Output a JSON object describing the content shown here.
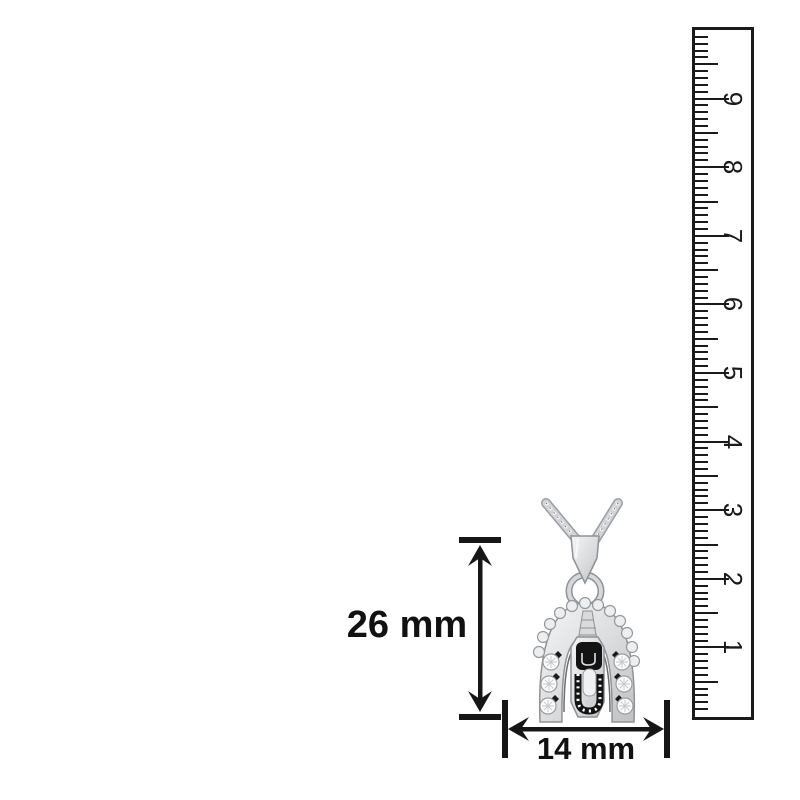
{
  "image": {
    "alt": "silver Balaji pendant with chain shown with dimension arrows and a ruler"
  },
  "measurements": {
    "height": "26 mm",
    "width": "14 mm"
  },
  "ruler": {
    "numbers": [
      "1",
      "2",
      "3",
      "4",
      "5",
      "6",
      "7",
      "8",
      "9"
    ]
  },
  "colors": {
    "ink": "#1a1a1a",
    "background": "#ffffff",
    "silver_light": "#eef0f1",
    "silver_mid": "#cfd2d5",
    "silver_dark": "#8f9296",
    "enamel_black": "#131313",
    "stone_white": "#fbfbfc"
  }
}
